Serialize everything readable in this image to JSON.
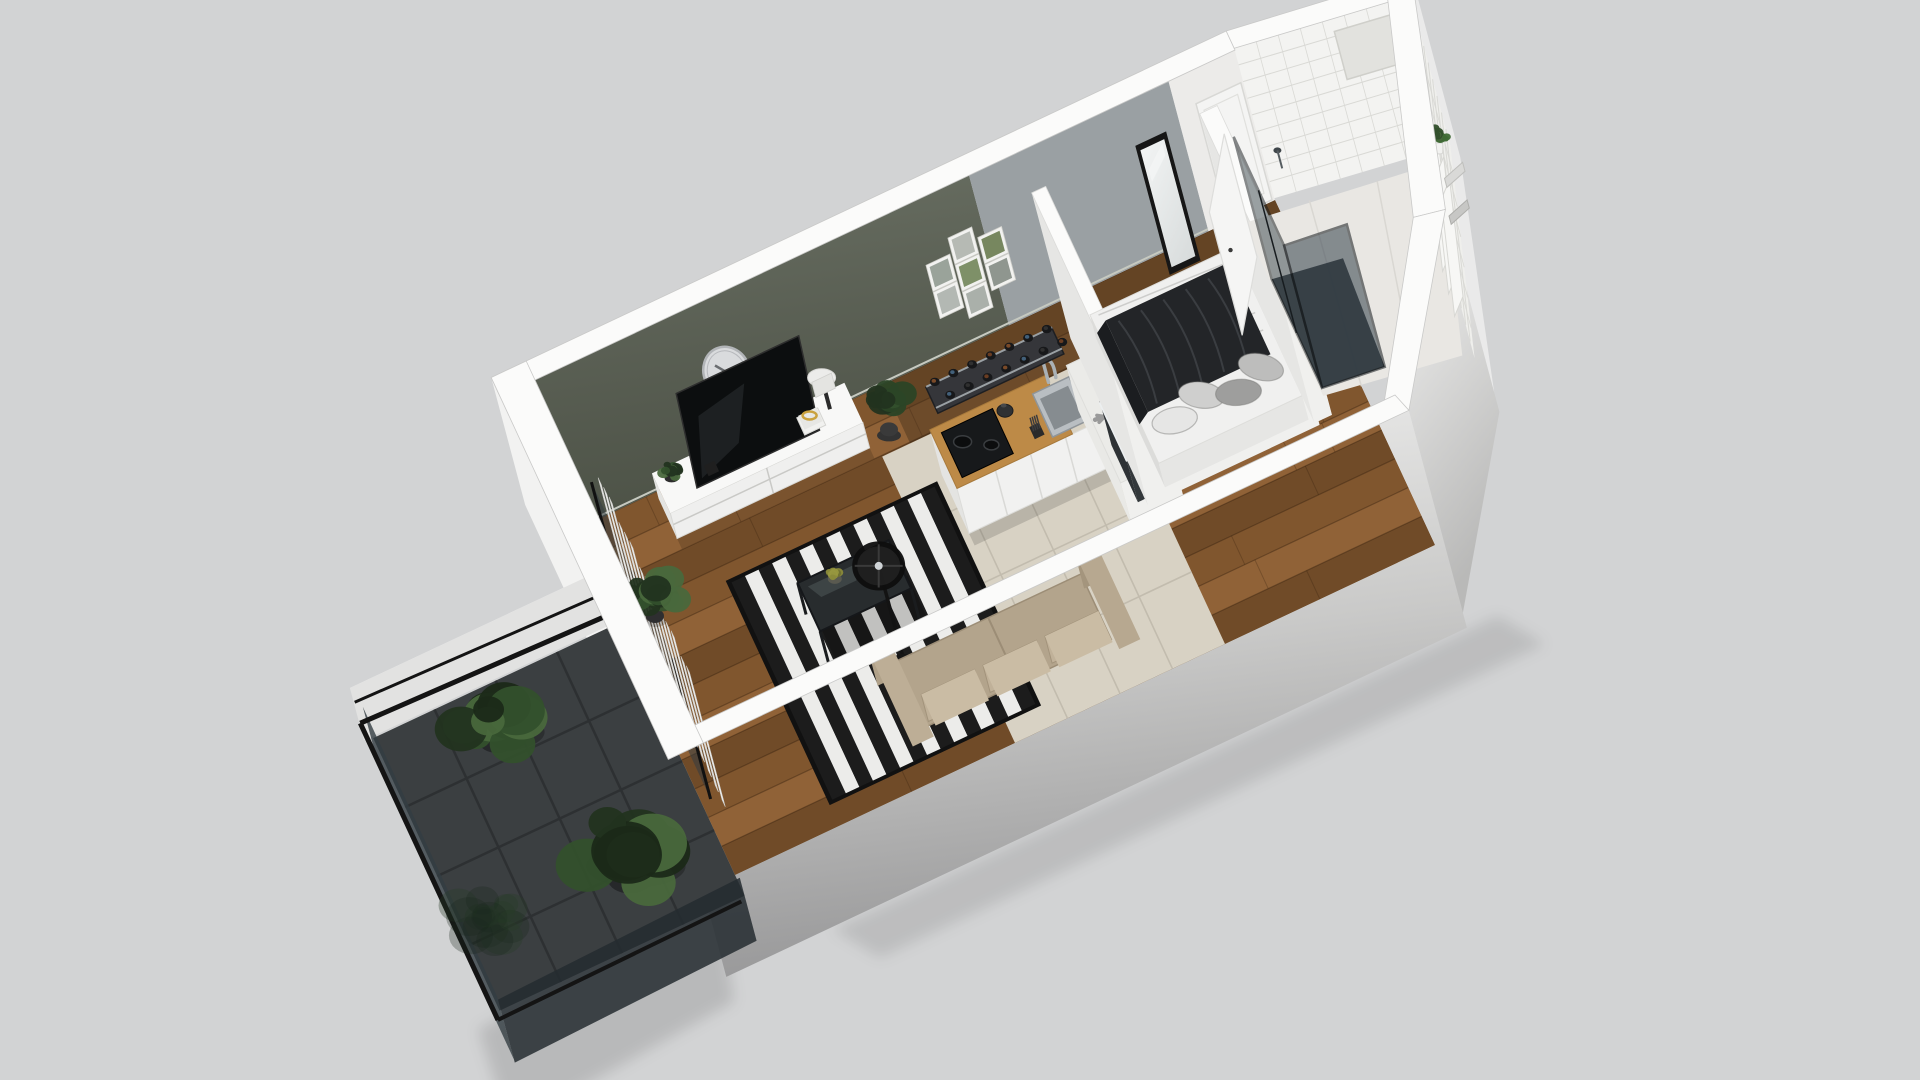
{
  "scene": {
    "background": "#d2d3d4",
    "description": "isometric 3d render of a studio apartment floor plan",
    "rooms": [
      "living-room",
      "kitchen",
      "bedroom-nook",
      "hallway",
      "bathroom",
      "balcony"
    ]
  },
  "colors": {
    "bg": "#d2d3d4",
    "wallTop": "#fbfbfa",
    "bandEdge": "#c9c9c8",
    "greenWall": "#6b7164",
    "greenWallDark": "#565c50",
    "grayWall": "#9aa0a3",
    "entryWall": "#ecebe9",
    "extLight": "#f2f2f1",
    "extDark": "#989899",
    "wood": "#80562f",
    "woodLight": "#916439",
    "woodDark": "#6e4a28",
    "hallTint": "#3d2a18",
    "tileBeige": "#d8d2c4",
    "tileGrout": "#c2bcae",
    "bathFloor": "#e9e7e3",
    "bathTile": "#f3f3f1",
    "bathGrout": "#d9d9d5",
    "rugDark": "#1c1c1c",
    "rugLight": "#ececea",
    "sofaBase": "#a99a82",
    "sofaSeat": "#b3a48c",
    "sofaBack": "#c0b199",
    "sofaTop": "#cabca4",
    "counterWood": "#bd8a47",
    "cabinet": "#f1f1f0",
    "cabinetSide": "#e4e4e2",
    "fridgeTop": "#ebebe8",
    "snowflake": "#9a9a9a",
    "cooktop": "#17191b",
    "sinkSteel": "#b9bec2",
    "sinkInner": "#868c90",
    "blanket": "#232528",
    "blanketFold": "#3a3d41",
    "mattress": "#f0f0ef",
    "pillowA": "#e6e6e5",
    "pillowB": "#cfcfce",
    "pillowC": "#9e9e9d",
    "pillowD": "#bdbdbc",
    "balconyTile": "#3b3f41",
    "balconyGrout": "#2d3032",
    "railing": "#141414",
    "glassDark": "#333d42",
    "plantDark": "#22331f",
    "plant": "#33502c",
    "plantLight": "#49683c",
    "tvBlack": "#0c0e0f",
    "tableDark": "#42474a",
    "clockFace": "#d9dbdd",
    "clockRim": "#b2b5b8",
    "mirrorFace": "#eef0f0",
    "frameBlack": "#161616",
    "white": "#f5f5f4",
    "lampBlack": "#212121",
    "gold": "#c9a23f"
  },
  "shell": {
    "wall_sections": [
      {
        "name": "accent-wall-green",
        "u1": 0.0,
        "u2": 0.62
      },
      {
        "name": "entry-wall-gray",
        "u1": 0.62,
        "u2": 0.905
      },
      {
        "name": "entry-wall-white",
        "u1": 0.905,
        "u2": 1.0
      }
    ]
  },
  "gallery": {
    "frame_du": 0.026,
    "frame_dh": 0.135,
    "frames": [
      {
        "u": 0.552,
        "h": 0.5,
        "print": "#9aa39a"
      },
      {
        "u": 0.552,
        "h": 0.32,
        "print": "#b3b8b3"
      },
      {
        "u": 0.589,
        "h": 0.6,
        "print": "#b6bab4"
      },
      {
        "u": 0.589,
        "h": 0.42,
        "print": "#7e9068"
      },
      {
        "u": 0.589,
        "h": 0.24,
        "print": "#aab0aa"
      },
      {
        "u": 0.627,
        "h": 0.52,
        "print": "#77875f"
      },
      {
        "u": 0.627,
        "h": 0.34,
        "print": "#8f968f"
      }
    ]
  },
  "clock": {
    "u": 0.246,
    "h": 0.51,
    "rx": 23,
    "ry": 26
  },
  "mirror": {
    "u1": 0.845,
    "u2": 0.879,
    "h1": -0.08,
    "h2": 0.7
  },
  "entry_door": {
    "u1": 0.932,
    "u2": 0.996,
    "h": 0.8
  },
  "blinds": {
    "count": 14,
    "v1": 0.255,
    "v2": 0.815
  },
  "balcony": {
    "plants": [
      {
        "x": 497,
        "y": 718,
        "r": 52
      },
      {
        "x": 630,
        "y": 852,
        "r": 62
      }
    ]
  },
  "indoor_plants": [
    {
      "x": 655,
      "y": 596,
      "r": 30
    },
    {
      "u": 0.428,
      "v": 0.115,
      "r": 26
    },
    {
      "u": 0.138,
      "v": 0.055,
      "r": 12
    }
  ],
  "console": {
    "u1": 0.115,
    "u2": 0.39,
    "v1": 0.02,
    "v2": 0.135,
    "h": 0.17
  },
  "tv": {
    "u1": 0.16,
    "u2": 0.335,
    "h1": 0.17,
    "h2": 0.6
  },
  "rug": {
    "u1": 0.155,
    "u2": 0.445,
    "v1": 0.3,
    "v2": 0.93,
    "stripes": 15
  },
  "coffee_table": {
    "u1": 0.225,
    "u2": 0.355,
    "v1": 0.46,
    "v2": 0.6,
    "h": 0.21
  },
  "floor_lamp": {
    "u": 0.315,
    "v": 0.675,
    "r": 24
  },
  "sofa": {
    "u1": 0.3,
    "u2": 0.565,
    "v1": 0.72,
    "v2": 0.99
  },
  "kitchen": {
    "u1": 0.46,
    "u2": 0.67,
    "v1": 0.28,
    "v2": 0.45,
    "h": 0.3,
    "burners": 2
  },
  "fridge": {
    "u1": 0.655,
    "u2": 0.73,
    "v1": 0.28,
    "v2": 0.62
  },
  "wine_rack": {
    "bottles_per_row": 7,
    "rows": 2,
    "u1": 0.475,
    "u2": 0.655
  },
  "side_table": {
    "u1": 0.675,
    "u2": 0.775,
    "v1": 0.4,
    "v2": 0.565,
    "h": 0.28
  },
  "bed": {
    "u1": 0.715,
    "u2": 0.92,
    "v1": 0.13,
    "v2": 0.56,
    "h": 0.16,
    "pillows": 4
  },
  "bathroom": {
    "shelves": 3,
    "towels": 2,
    "has_plant": true,
    "has_shower": true
  }
}
